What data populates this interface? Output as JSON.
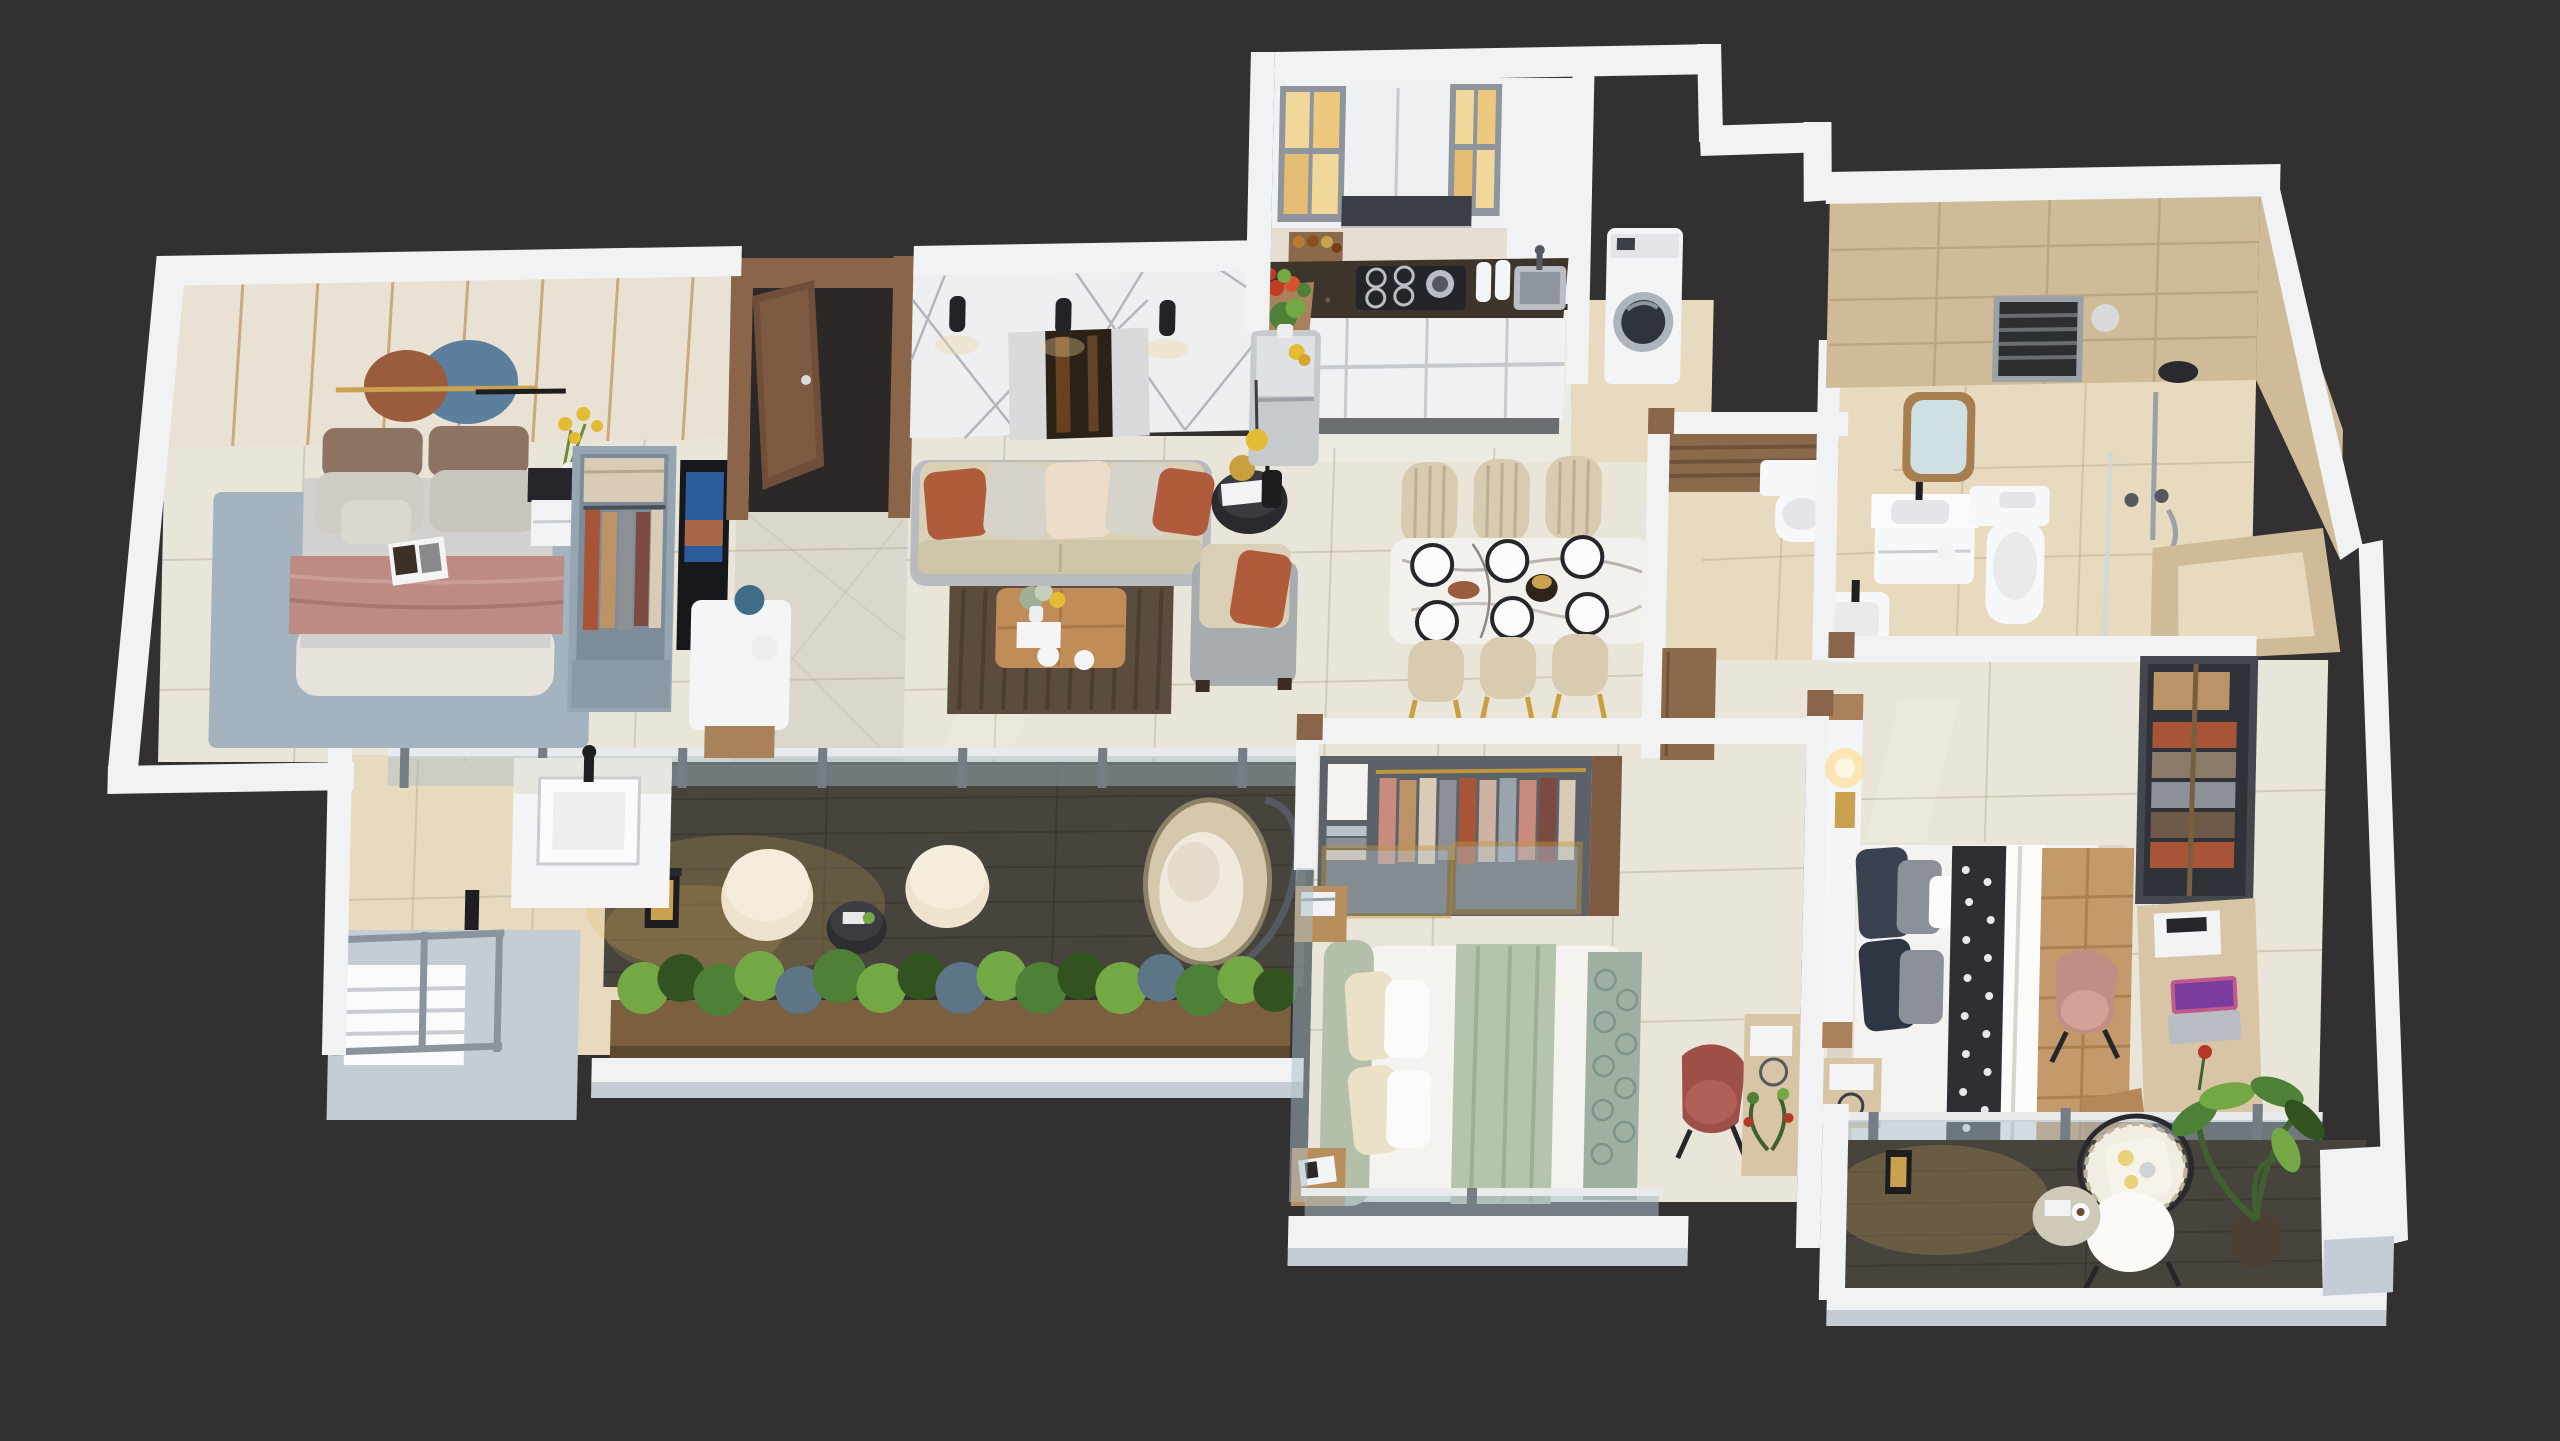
{
  "scene": {
    "title": "3D isometric floor plan render - 3 bedroom apartment",
    "background": "#323031"
  },
  "palette": {
    "background": "#323031",
    "wallTop": "#f1f2f4",
    "wallEdge": "#dcdfe3",
    "wallFaceGray": "#c6ccd3",
    "floorMain": "#e9e5d8",
    "floorFoyer": "#dcd7cd",
    "floorKitchen": "#ecebe1",
    "floorBath": "#e8dabf",
    "tileLine": "#a89c84",
    "panelCream": "#e9e2d4",
    "goldLine": "#c39c67",
    "featureWall": "#edeff1",
    "featureLine": "#b3b7bd",
    "artDark": "#2a2117",
    "artSilver": "#d8dadc",
    "sconce": "#232327",
    "sofaBeige": "#d9d0b6",
    "pillowTerracotta": "#b05c3c",
    "pillowGray": "#d6d3cb",
    "pillowCream": "#ecdcc8",
    "tweedGray": "#a7acb0",
    "woodTable": "#c08d58",
    "rugBrown": "#5c4c3e",
    "sideBlack": "#2a2a2e",
    "gold": "#c9a03f",
    "bed1Gray": "#d2d1cf",
    "bed1Rose": "#bd8a84",
    "bed1Base": "#e8e3da",
    "headboardBrown": "#8e7363",
    "rugBlue": "#a3b4c0",
    "nightBlack": "#27252b",
    "flowerYellow": "#e2bc34",
    "wardrobeBlue": "#96a5b2",
    "clothRust": "#a85537",
    "clothTan": "#bb9367",
    "clothCream": "#d9cbb5",
    "clothPlum": "#7d4a42",
    "tvBlack": "#17181c",
    "woodDoor": "#7d5a41",
    "doorOpening": "#2b2827",
    "cabinetWhite": "#eff1f3",
    "cabGlow": "#f2d79a",
    "hoodDark": "#3b3e44",
    "counterGranite": "#3d342b",
    "steel": "#b9bec4",
    "fridgeSilver": "#c6cacd",
    "washerWhite": "#f3f4f5",
    "washerGlass": "#2f343a",
    "travertine": "#cfbb97",
    "travLine": "#b7a27d",
    "slatWood": "#8a6a4a",
    "bed2Sage": "#b4bfa9",
    "bed2White": "#f4f3ef",
    "runnerSage": "#9db0a2",
    "wardrobe2Dark": "#5d6168",
    "goldFrame": "#c0953e",
    "mauveChair": "#9e5048",
    "pillowNavy": "#3a4252",
    "camelQuilt": "#c49a6c",
    "patternDark": "#2e2f33",
    "rugWarm": "#ddd5c8",
    "deskWood": "#d7c5a5",
    "chairBlush": "#c18e85",
    "closetFrame": "#43474e",
    "deckWood": "#47433d",
    "plankLine": "#36332f",
    "warmGlow": "#e4b45a",
    "planterWood": "#7b5f3e",
    "plantGreen": "#4f8038",
    "plantLight": "#74a845",
    "plantDark": "#32531f",
    "plantBlue": "#5c7587",
    "poufCream": "#ecdfc8",
    "eggRattan": "#d6c8ad",
    "eggFrame": "#555a62",
    "glassRail": "#a9bec7",
    "railPost": "#767d85",
    "chrome": "#9aa1a8",
    "marbleTable": "#f3f1ee"
  },
  "rooms": [
    {
      "id": "bedroom-1",
      "label": "Bedroom 1",
      "furniture": [
        "panel wall with oval decor",
        "double bed with rose blanket",
        "nightstand with yellow flowers",
        "open wardrobe",
        "tv-unit"
      ]
    },
    {
      "id": "foyer",
      "label": "Entry Foyer",
      "furniture": [
        "open wooden entry door"
      ]
    },
    {
      "id": "living-room",
      "label": "Living Room",
      "furniture": [
        "feature wall with abstract art",
        "3 wall sconces",
        "3-seat beige sofa",
        "tweed armchair",
        "round side table with lamp",
        "wooden coffee table",
        "striped brown rug"
      ]
    },
    {
      "id": "kitchen",
      "label": "Kitchen",
      "furniture": [
        "lit glass upper cabinets",
        "range hood",
        "gas stove",
        "sink",
        "granite counter",
        "base cabinets",
        "fridge with plant",
        "vegetable basket",
        "pendant light"
      ]
    },
    {
      "id": "utility",
      "label": "Laundry Nook",
      "furniture": [
        "front-load washing machine"
      ]
    },
    {
      "id": "dining",
      "label": "Dining Area",
      "furniture": [
        "marble dining table",
        "6 place settings",
        "6 beige chairs with gold legs"
      ]
    },
    {
      "id": "common-bathroom",
      "label": "Common Bathroom",
      "furniture": [
        "wood slat feature wall",
        "wall-hung toilet",
        "basin with black faucet",
        "wood cabinet"
      ]
    },
    {
      "id": "master-bathroom",
      "label": "Master Bathroom",
      "furniture": [
        "travertine walls",
        "framed mirror",
        "louver window",
        "vanity basin",
        "wall-hung toilet",
        "shower set",
        "sunken tub ledge"
      ]
    },
    {
      "id": "bedroom-2",
      "label": "Bedroom 2",
      "furniture": [
        "open wardrobe with gold glass sliders",
        "bed with sage headboard",
        "two nightstands",
        "mauve tub chair",
        "console with plant"
      ]
    },
    {
      "id": "master-bedroom",
      "label": "Master Bedroom",
      "furniture": [
        "headboard wall with glowing lamp",
        "bed with camel quilt and patterned runner",
        "open closet with clothes",
        "desk with laptop",
        "blush desk chair"
      ]
    },
    {
      "id": "balcony-long",
      "label": "Wrap Balcony / Deck",
      "furniture": [
        "glass balustrade",
        "wash counter with basin",
        "black lantern",
        "two cream poufs",
        "small round table",
        "hanging egg chair",
        "wooden planter boxes",
        "railed service platform"
      ]
    },
    {
      "id": "master-balcony",
      "label": "Master Balcony",
      "furniture": [
        "rattan chair with cushions",
        "round side table with coffee",
        "potted plant",
        "glass balustrade"
      ]
    }
  ]
}
